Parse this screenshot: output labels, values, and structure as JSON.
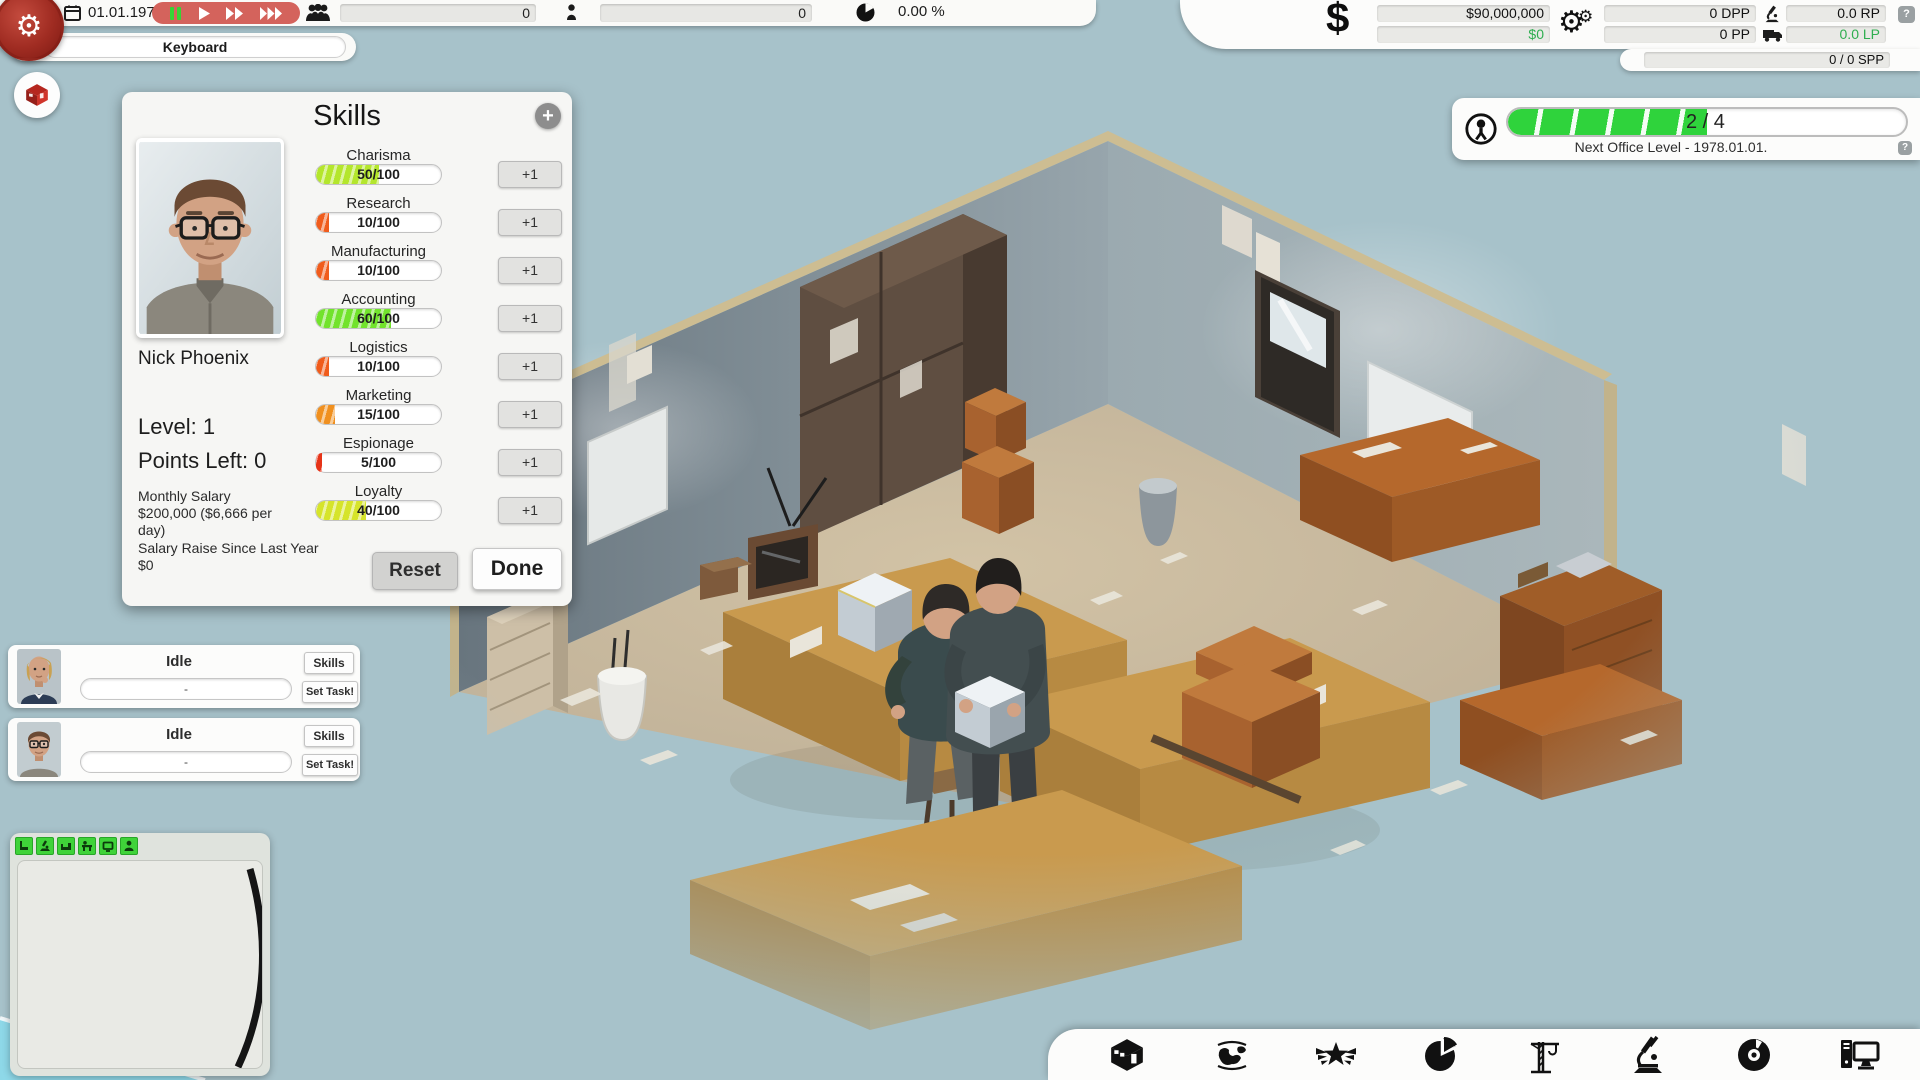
{
  "colors": {
    "accent_red": "#d4635c",
    "green_positive": "#2fae50",
    "progress_green": "#2fd33c",
    "bg": "#a7c2ca"
  },
  "top_bar": {
    "date": "01.01.1972",
    "employees_count": "0",
    "fans_count": "0",
    "market_share": "0.00 %"
  },
  "research_slot": {
    "label": "Keyboard"
  },
  "skills_panel": {
    "title": "Skills",
    "add_label": "+",
    "employee_name": "Nick Phoenix",
    "level_label": "Level: 1",
    "points_left_label": "Points Left: 0",
    "monthly_salary_label": "Monthly Salary",
    "monthly_salary_value": "$200,000 ($6,666 per day)",
    "salary_raise_label": "Salary Raise Since Last Year",
    "salary_raise_value": "$0",
    "increment_label": "+1",
    "reset_label": "Reset",
    "done_label": "Done",
    "skills": [
      {
        "name": "Charisma",
        "value": 50,
        "max": 100,
        "display": "50/100",
        "color": "#b4e62c"
      },
      {
        "name": "Research",
        "value": 10,
        "max": 100,
        "display": "10/100",
        "color": "#f05c1c"
      },
      {
        "name": "Manufacturing",
        "value": 10,
        "max": 100,
        "display": "10/100",
        "color": "#f05c1c"
      },
      {
        "name": "Accounting",
        "value": 60,
        "max": 100,
        "display": "60/100",
        "color": "#72e32c"
      },
      {
        "name": "Logistics",
        "value": 10,
        "max": 100,
        "display": "10/100",
        "color": "#f05c1c"
      },
      {
        "name": "Marketing",
        "value": 15,
        "max": 100,
        "display": "15/100",
        "color": "#f0901f"
      },
      {
        "name": "Espionage",
        "value": 5,
        "max": 100,
        "display": "5/100",
        "color": "#e63418"
      },
      {
        "name": "Loyalty",
        "value": 40,
        "max": 100,
        "display": "40/100",
        "color": "#d6e42a"
      }
    ]
  },
  "finance_panel": {
    "currency_symbol": "$",
    "balance": "$90,000,000",
    "cash_flow": "$0",
    "dpp": "0 DPP",
    "pp": "0 PP",
    "rp": "0.0 RP",
    "lp": "0.0 LP",
    "spp": "0 / 0 SPP",
    "help_label": "?"
  },
  "office_panel": {
    "progress_label": "2 / 4",
    "progress_fraction": 0.5,
    "next_level_text": "Next Office Level - 1978.01.01.",
    "help_label": "?"
  },
  "employee_cards": [
    {
      "status": "Idle",
      "task": "-",
      "skills_label": "Skills",
      "set_task_label": "Set Task!"
    },
    {
      "status": "Idle",
      "task": "-",
      "skills_label": "Skills",
      "set_task_label": "Set Task!"
    }
  ],
  "dock": {
    "items": [
      "company",
      "world-map",
      "achievements",
      "market-stats",
      "construction",
      "research",
      "products",
      "hardware"
    ]
  },
  "minimap": {
    "icons": [
      "furniture",
      "research-item",
      "couch",
      "desk",
      "tv",
      "staff"
    ]
  }
}
